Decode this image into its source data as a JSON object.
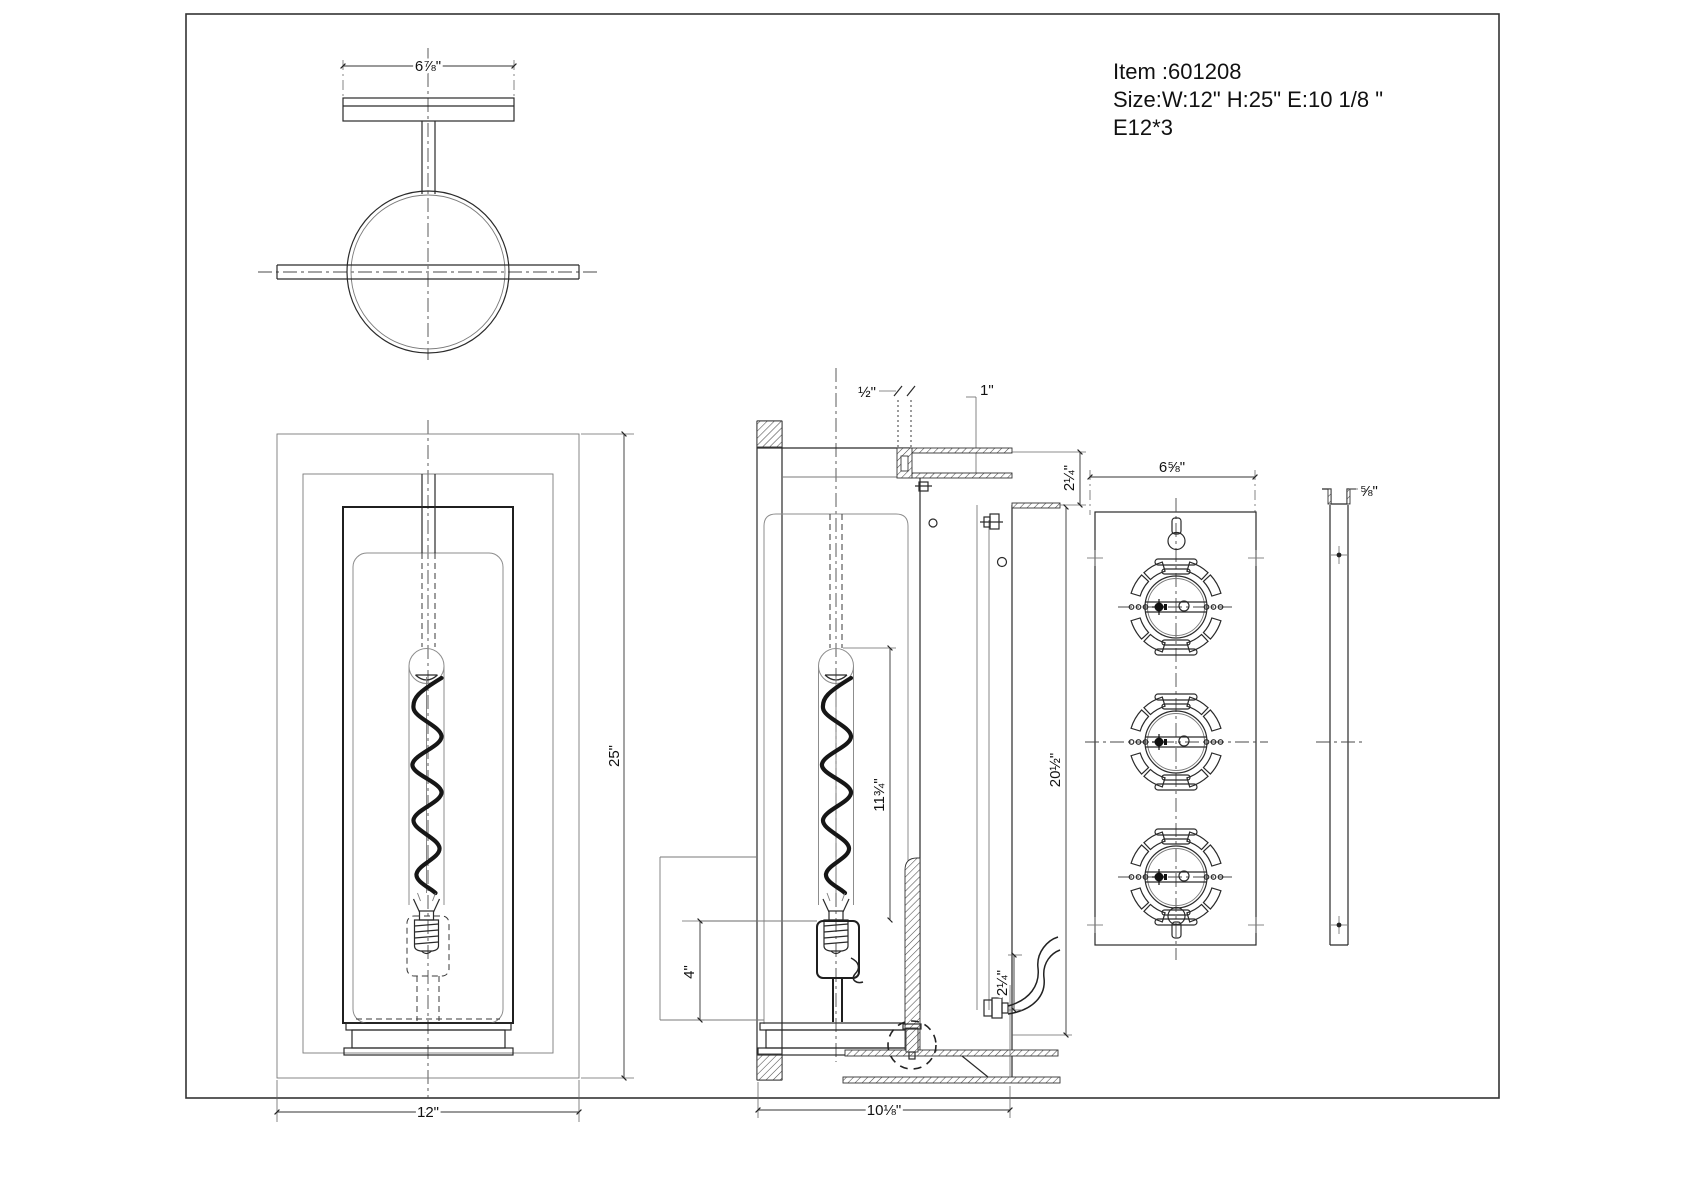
{
  "info": {
    "item": "Item :601208",
    "size": "Size:W:12\"  H:25\"  E:10 1/8 \"",
    "lamp": "E12*3"
  },
  "dims": {
    "top_width": "6⅞\"",
    "front_height": "25\"",
    "front_width": "12\"",
    "frame_thickness": "½\"",
    "frame_depth": "1\"",
    "top_offset": "2¼\"",
    "backplate_height": "20½\"",
    "bulb_length": "11¾\"",
    "socket_box_height": "4\"",
    "extension_depth": "10⅛\"",
    "bottom_offset": "2¼\"",
    "backplate_width": "6⅝\"",
    "backplate_thickness": "⅝\""
  }
}
